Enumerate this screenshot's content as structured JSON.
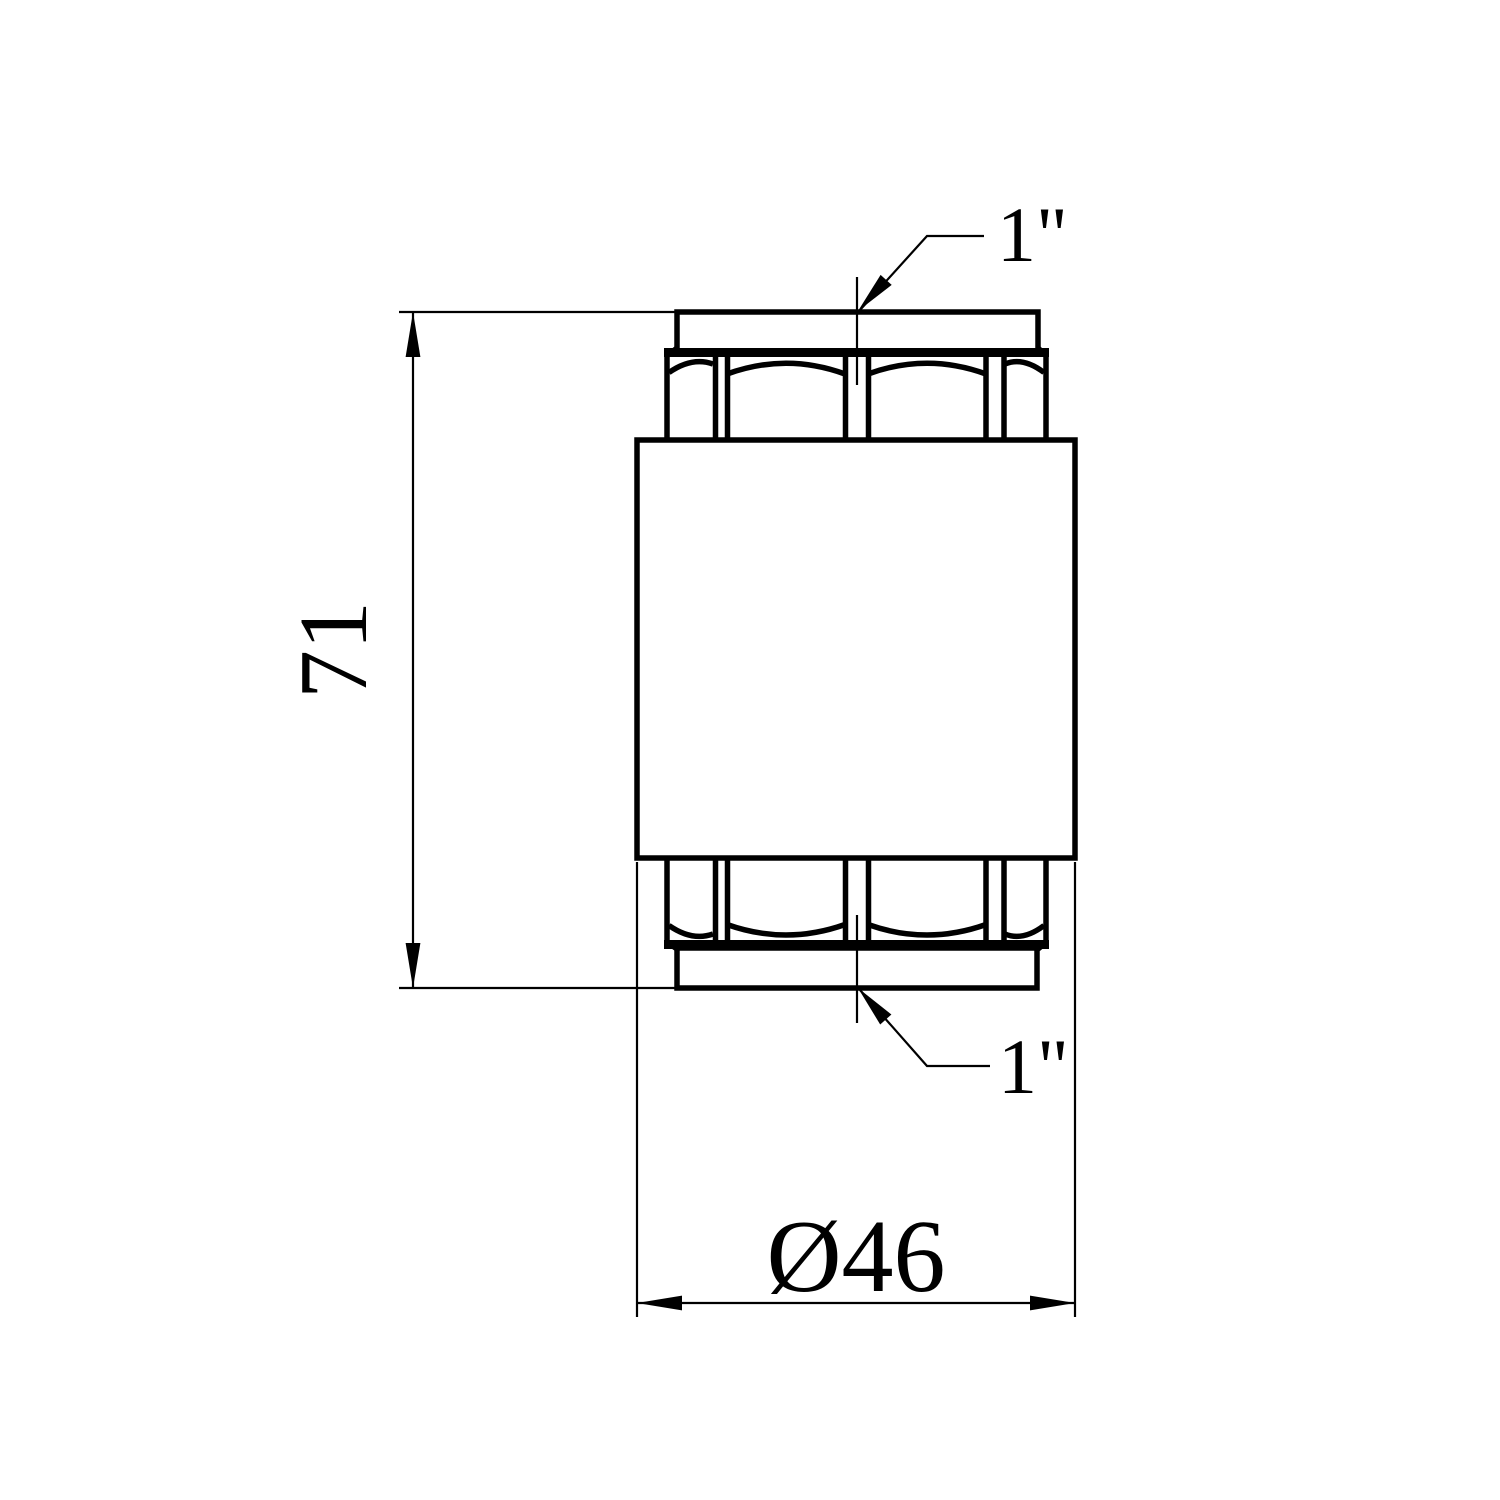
{
  "page": {
    "background": "#ffffff",
    "ink": "#000000"
  },
  "drawing": {
    "view": "front-view-technical-drawing",
    "dimensions": {
      "height": {
        "label": "71",
        "value": 71
      },
      "diameter": {
        "label": "Ø46",
        "value": 46
      },
      "top_thread": {
        "label": "1\""
      },
      "bottom_thread": {
        "label": "1\""
      }
    }
  }
}
